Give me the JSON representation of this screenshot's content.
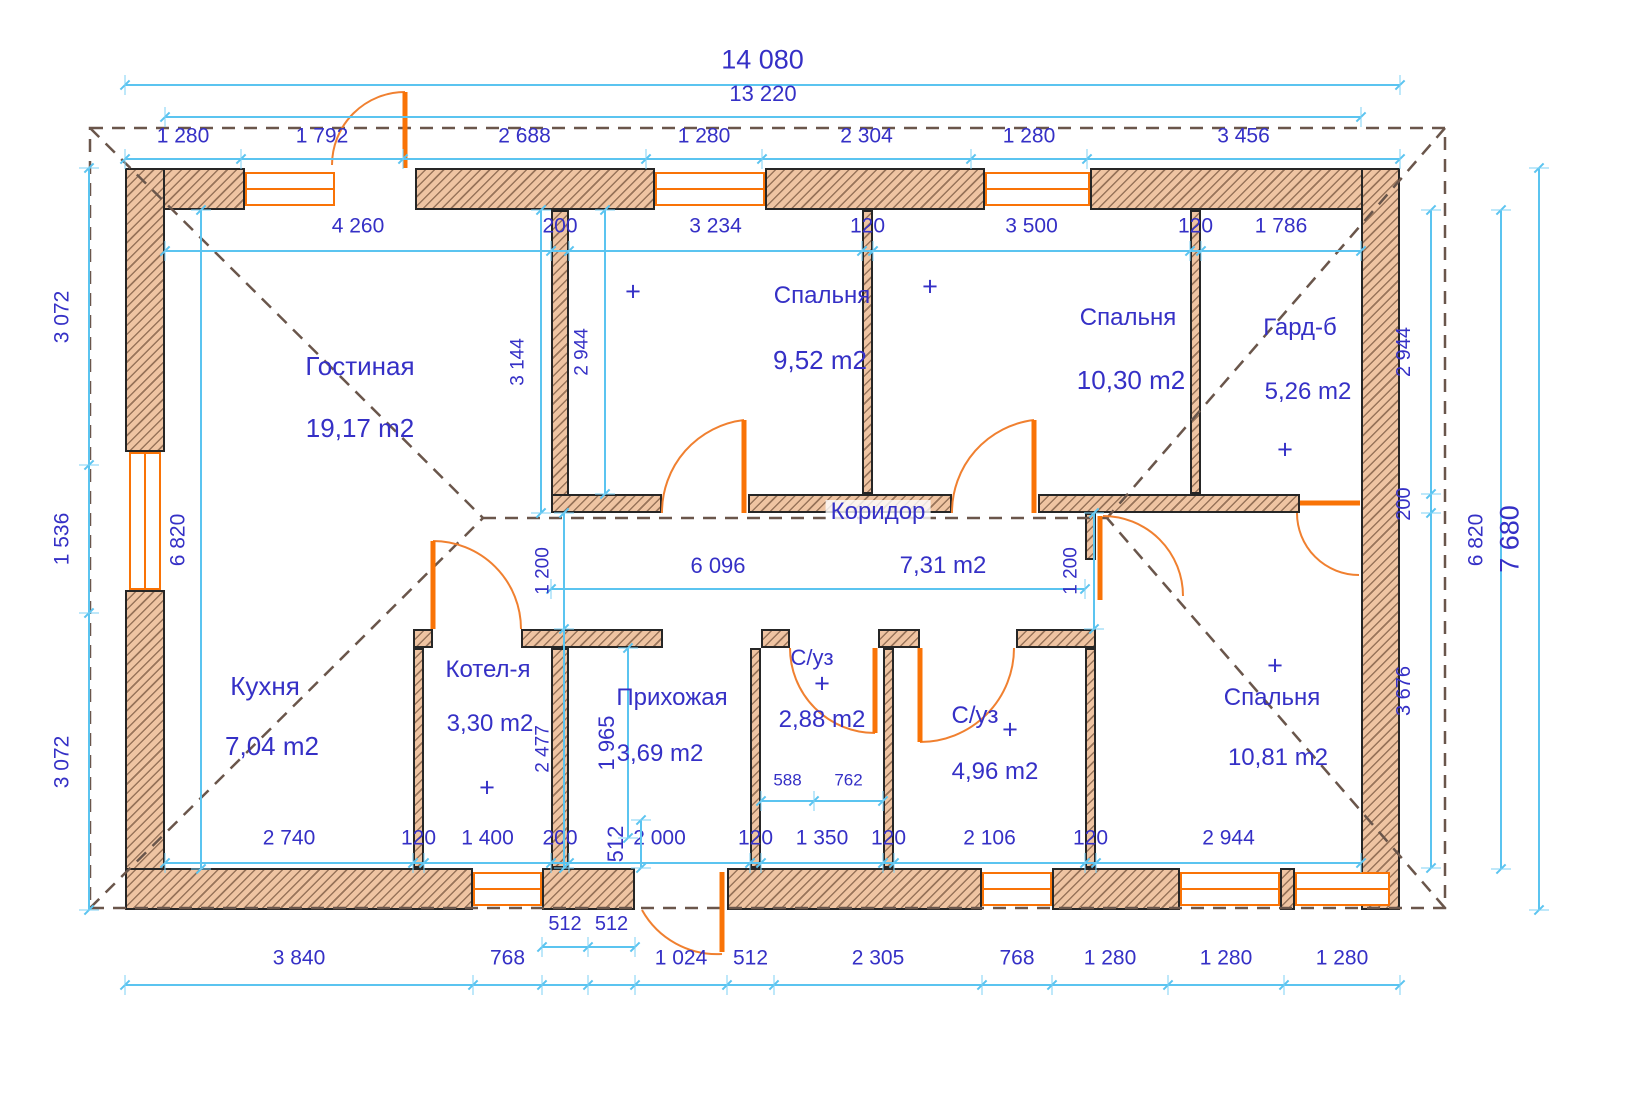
{
  "meta": {
    "drawing_type": "house floor plan",
    "units": "mm"
  },
  "colors": {
    "text_blue": "#3530c6",
    "dim_cyan": "#5bc4f0",
    "wall_fill": "#efc4a2",
    "wall_border": "#262626",
    "opening_orange": "#f97306",
    "door_arc_orange": "#f08030",
    "roof_dash_brown": "#6a564b"
  },
  "rooms": [
    {
      "name": "Гостиная",
      "area": "19,17 m2",
      "np": [
        360,
        366
      ],
      "ap": [
        360,
        428
      ],
      "nf": 26,
      "af": 26,
      "bg": false
    },
    {
      "name": "Спальня",
      "area": "9,52 m2",
      "np": [
        822,
        296
      ],
      "ap": [
        820,
        360
      ],
      "nf": 24,
      "af": 26,
      "bg": false
    },
    {
      "name": "Спальня",
      "area": "10,30 m2",
      "np": [
        1128,
        318
      ],
      "ap": [
        1131,
        380
      ],
      "nf": 24,
      "af": 26,
      "bg": false
    },
    {
      "name": "Гард-б",
      "area": "5,26 m2",
      "np": [
        1300,
        328
      ],
      "ap": [
        1308,
        392
      ],
      "nf": 24,
      "af": 24,
      "bg": false
    },
    {
      "name": "Коридор",
      "area": "",
      "np": [
        878,
        512
      ],
      "ap": [
        0,
        0
      ],
      "nf": 24,
      "af": 24,
      "bg": true
    },
    {
      "name": "Кухня",
      "area": "7,04 m2",
      "np": [
        265,
        686
      ],
      "ap": [
        272,
        746
      ],
      "nf": 26,
      "af": 26,
      "bg": false
    },
    {
      "name": "Котел-я",
      "area": "3,30 m2",
      "np": [
        488,
        670
      ],
      "ap": [
        490,
        724
      ],
      "nf": 24,
      "af": 24,
      "bg": false
    },
    {
      "name": "Прихожая",
      "area": "3,69 m2",
      "np": [
        672,
        698
      ],
      "ap": [
        660,
        754
      ],
      "nf": 24,
      "af": 24,
      "bg": false
    },
    {
      "name": "С/уз",
      "area": "2,88 m2",
      "np": [
        812,
        658
      ],
      "ap": [
        822,
        720
      ],
      "nf": 22,
      "af": 24,
      "bg": false
    },
    {
      "name": "С/уз",
      "area": "4,96 m2",
      "np": [
        975,
        716
      ],
      "ap": [
        995,
        772
      ],
      "nf": 24,
      "af": 24,
      "bg": false
    },
    {
      "name": "Спальня",
      "area": "10,81 m2",
      "np": [
        1272,
        698
      ],
      "ap": [
        1278,
        758
      ],
      "nf": 24,
      "af": 24,
      "bg": false
    }
  ],
  "free_labels": [
    {
      "text": "6 096",
      "x": 718,
      "y": 566,
      "f": 22
    },
    {
      "text": "7,31 m2",
      "x": 943,
      "y": 566,
      "f": 24
    }
  ],
  "plus_marks": [
    [
      633,
      292
    ],
    [
      930,
      287
    ],
    [
      1285,
      450
    ],
    [
      487,
      788
    ],
    [
      822,
      684
    ],
    [
      1010,
      730
    ],
    [
      1275,
      666
    ]
  ],
  "walls": [
    [
      125,
      168,
      120,
      42
    ],
    [
      415,
      168,
      240,
      42
    ],
    [
      765,
      168,
      220,
      42
    ],
    [
      1090,
      168,
      310,
      42
    ],
    [
      125,
      168,
      40,
      284
    ],
    [
      125,
      590,
      40,
      320
    ],
    [
      1361,
      168,
      39,
      742
    ],
    [
      125,
      868,
      348,
      42
    ],
    [
      542,
      868,
      93,
      42
    ],
    [
      727,
      868,
      255,
      42
    ],
    [
      1052,
      868,
      128,
      42
    ],
    [
      1280,
      868,
      15,
      42
    ],
    [
      551,
      210,
      18,
      303
    ],
    [
      862,
      210,
      11,
      284
    ],
    [
      1190,
      210,
      11,
      284
    ],
    [
      551,
      494,
      111,
      19
    ],
    [
      748,
      494,
      204,
      19
    ],
    [
      1038,
      494,
      262,
      19
    ],
    [
      413,
      629,
      20,
      19
    ],
    [
      521,
      629,
      142,
      19
    ],
    [
      761,
      629,
      29,
      19
    ],
    [
      878,
      629,
      42,
      19
    ],
    [
      1016,
      629,
      80,
      19
    ],
    [
      413,
      648,
      11,
      220
    ],
    [
      551,
      648,
      18,
      220
    ],
    [
      750,
      648,
      11,
      220
    ],
    [
      883,
      648,
      11,
      220
    ],
    [
      1085,
      648,
      11,
      220
    ],
    [
      1085,
      513,
      11,
      47
    ]
  ],
  "windows": [
    {
      "r": [
        245,
        172,
        90,
        34
      ],
      "o": "h"
    },
    {
      "r": [
        655,
        172,
        110,
        34
      ],
      "o": "h"
    },
    {
      "r": [
        985,
        172,
        105,
        34
      ],
      "o": "h"
    },
    {
      "r": [
        129,
        452,
        32,
        138
      ],
      "o": "v"
    },
    {
      "r": [
        473,
        872,
        69,
        34
      ],
      "o": "h"
    },
    {
      "r": [
        982,
        872,
        70,
        34
      ],
      "o": "h"
    },
    {
      "r": [
        1180,
        872,
        100,
        34
      ],
      "o": "h"
    },
    {
      "r": [
        1295,
        872,
        95,
        34
      ],
      "o": "h"
    }
  ],
  "doors": [
    {
      "name": "entry-door-top",
      "arc": "M 405 92 A 73 73 0 0 0 332 165",
      "leaf": [
        405,
        92,
        405,
        168
      ]
    },
    {
      "name": "bedroom1-door",
      "arc": "M 744 420 A 93 93 0 0 0 662 513",
      "leaf": [
        744,
        420,
        744,
        513
      ]
    },
    {
      "name": "bedroom2-door",
      "arc": "M 1034 420 A 93 93 0 0 0 952 513",
      "leaf": [
        1034,
        420,
        1034,
        513
      ]
    },
    {
      "name": "bedroom-right-door",
      "arc": "M 1103 516 A 80 80 0 0 1 1183 596",
      "leaf": [
        1100,
        516,
        1100,
        600
      ]
    },
    {
      "name": "wardrobe-door",
      "arc": "M 1297 513 A 62 62 0 0 0 1359 575",
      "leaf": [
        1300,
        503,
        1360,
        503
      ]
    },
    {
      "name": "boiler-door",
      "arc": "M 433 541 A 88 88 0 0 1 521 629",
      "leaf": [
        433,
        541,
        433,
        629
      ]
    },
    {
      "name": "bath1-door",
      "arc": "M 790 648 A 85 85 0 0 0 875 733",
      "leaf": [
        875,
        648,
        875,
        733
      ]
    },
    {
      "name": "bath2-door",
      "arc": "M 920 742 A 94 94 0 0 0 1014 648",
      "leaf": [
        920,
        648,
        920,
        742
      ]
    },
    {
      "name": "main-entrance-door",
      "arc": "M 642 910 A 86 86 0 0 0 722 954",
      "leaf": [
        722,
        872,
        722,
        952
      ]
    }
  ],
  "roof": {
    "rect": "M 90 128 H 1445 V 908 H 90 Z",
    "lines": [
      [
        90,
        128,
        483,
        518
      ],
      [
        90,
        908,
        483,
        518
      ],
      [
        1445,
        128,
        1107,
        518
      ],
      [
        1445,
        908,
        1107,
        518
      ],
      [
        483,
        518,
        1107,
        518
      ]
    ]
  },
  "dim_chains": [
    {
      "o": "h",
      "line": 84,
      "off": -24,
      "b": [
        125,
        1400
      ],
      "l": [
        "14 080"
      ],
      "f": 27
    },
    {
      "o": "h",
      "line": 116,
      "off": -22,
      "b": [
        165,
        1361
      ],
      "l": [
        "13 220"
      ],
      "f": 22
    },
    {
      "o": "h",
      "line": 158,
      "off": -22,
      "b": [
        125,
        241,
        403,
        646,
        762,
        971,
        1087,
        1400
      ],
      "l": [
        "1 280",
        "1 792",
        "2 688",
        "1 280",
        "2 304",
        "1 280",
        "3 456"
      ],
      "f": 21
    },
    {
      "o": "h",
      "line": 250,
      "off": -24,
      "b": [
        165,
        551,
        569,
        862,
        873,
        1190,
        1201,
        1361
      ],
      "l": [
        "4 260",
        "200",
        "3 234",
        "120",
        "3 500",
        "120",
        "1 786"
      ],
      "f": 21
    },
    {
      "o": "h",
      "line": 588,
      "off": -24,
      "b": [
        551,
        1085
      ],
      "l": [
        ""
      ],
      "f": 21
    },
    {
      "o": "h",
      "line": 800,
      "off": -20,
      "b": [
        761,
        814,
        883
      ],
      "l": [
        "588",
        "762"
      ],
      "f": 17
    },
    {
      "o": "h",
      "line": 862,
      "off": -24,
      "b": [
        165,
        413,
        424,
        551,
        569,
        750,
        761,
        883,
        894,
        1085,
        1096,
        1361
      ],
      "l": [
        "2 740",
        "120",
        "1 400",
        "200",
        "2 000",
        "120",
        "1 350",
        "120",
        "2 106",
        "120",
        "2 944"
      ],
      "f": 21
    },
    {
      "o": "h",
      "line": 946,
      "off": -22,
      "b": [
        542,
        588,
        635
      ],
      "l": [
        "512",
        "512"
      ],
      "f": 20
    },
    {
      "o": "h",
      "line": 984,
      "off": -26,
      "b": [
        125,
        473,
        542,
        588,
        635,
        727,
        774,
        982,
        1052,
        1168,
        1284,
        1400
      ],
      "l": [
        "3 840",
        "768",
        "",
        "",
        "1 024",
        "512",
        "2 305",
        "768",
        "1 280",
        "1 280",
        "1 280"
      ],
      "f": 21
    },
    {
      "o": "v",
      "line": 88,
      "off": -26,
      "b": [
        168,
        465,
        613,
        910
      ],
      "l": [
        "3 072",
        "1 536",
        "3 072"
      ],
      "f": 21
    },
    {
      "o": "v",
      "line": 200,
      "off": -22,
      "b": [
        210,
        869
      ],
      "l": [
        "6 820"
      ],
      "f": 21
    },
    {
      "o": "v",
      "line": 540,
      "off": -22,
      "b": [
        210,
        513
      ],
      "l": [
        "3 144"
      ],
      "f": 19
    },
    {
      "o": "v",
      "line": 604,
      "off": -22,
      "b": [
        210,
        494
      ],
      "l": [
        "2 944"
      ],
      "f": 19
    },
    {
      "o": "v",
      "line": 563,
      "off": -20,
      "b": [
        513,
        629,
        868
      ],
      "l": [
        "1 200",
        "2 477"
      ],
      "f": 19
    },
    {
      "o": "v",
      "line": 1093,
      "off": -22,
      "b": [
        513,
        629
      ],
      "l": [
        "1 200"
      ],
      "f": 19
    },
    {
      "o": "v",
      "line": 627,
      "off": -20,
      "b": [
        648,
        838
      ],
      "l": [
        "1 965"
      ],
      "f": 22
    },
    {
      "o": "v",
      "line": 640,
      "off": -24,
      "b": [
        820,
        868
      ],
      "l": [
        "512"
      ],
      "f": 22
    },
    {
      "o": "v",
      "line": 1430,
      "off": -26,
      "b": [
        210,
        494,
        513,
        868
      ],
      "l": [
        "2 944",
        "200",
        "3 676"
      ],
      "f": 20
    },
    {
      "o": "v",
      "line": 1500,
      "off": -24,
      "b": [
        210,
        869
      ],
      "l": [
        "6 820"
      ],
      "f": 21
    },
    {
      "o": "v",
      "line": 1538,
      "off": -28,
      "b": [
        168,
        910
      ],
      "l": [
        "7 680"
      ],
      "f": 27
    }
  ]
}
